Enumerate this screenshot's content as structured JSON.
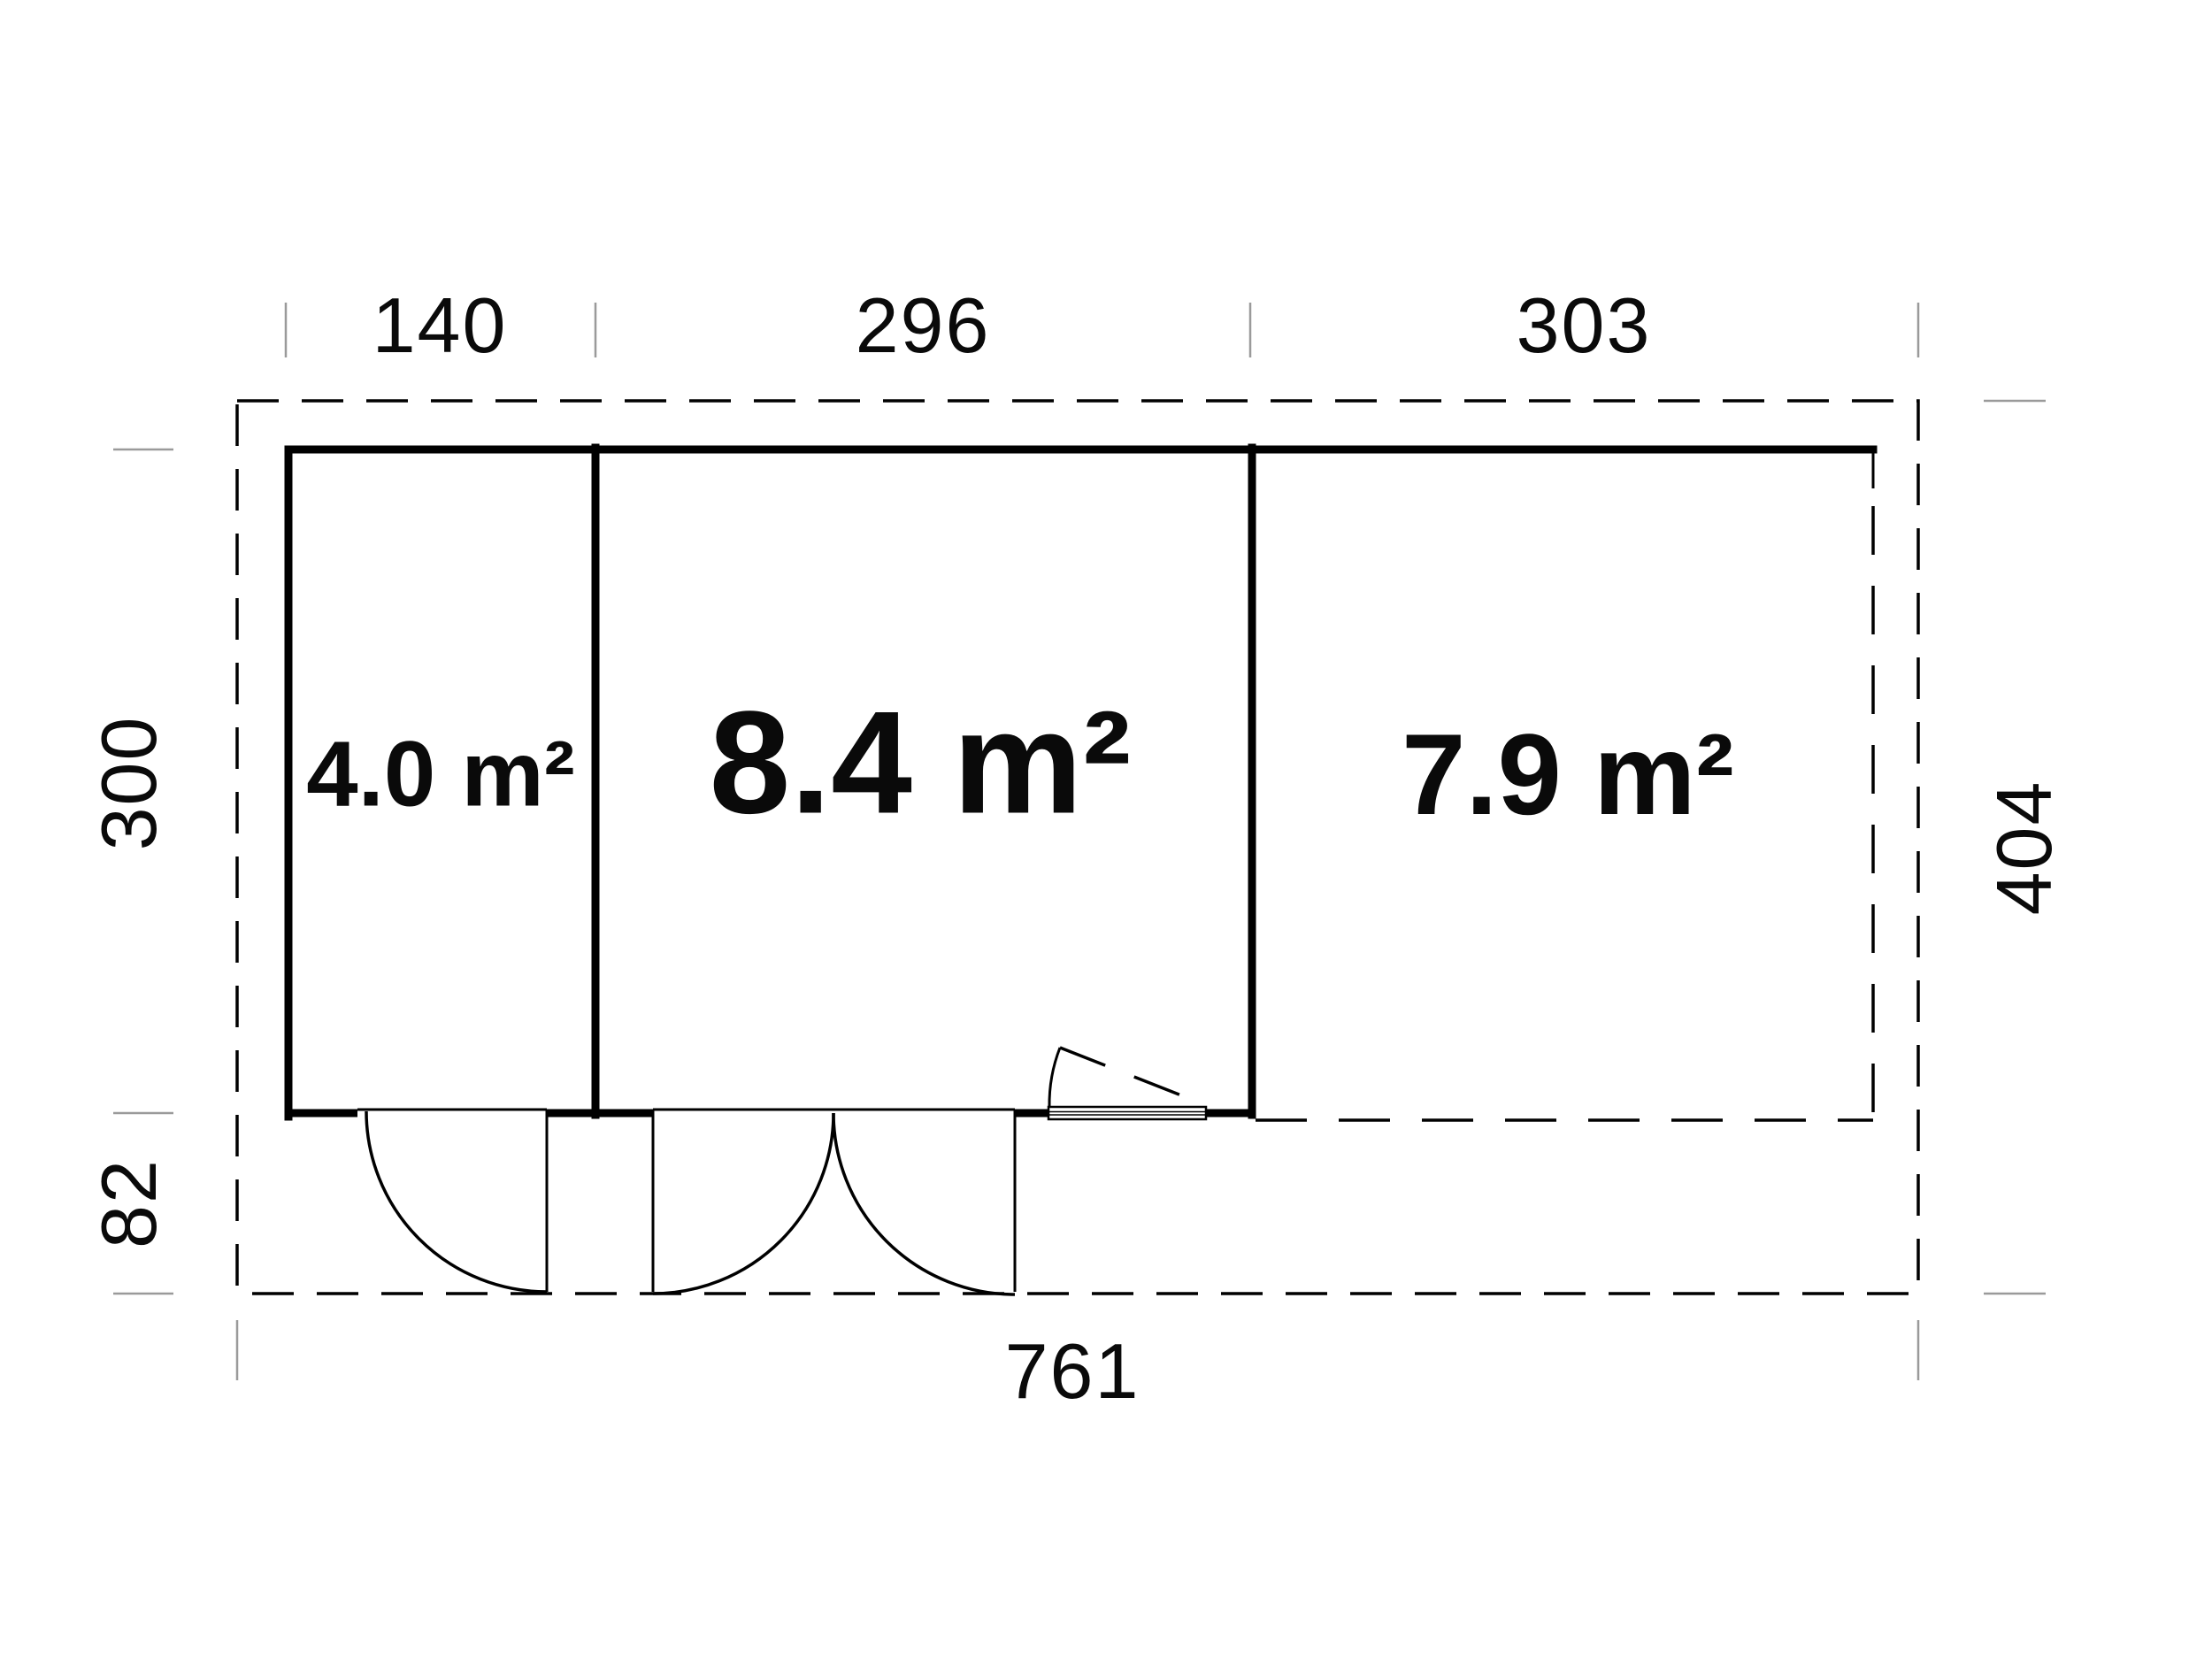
{
  "plan": {
    "title": "garden-house floor plan",
    "rooms": [
      {
        "id": "room-1",
        "area_label": "4.0 m²"
      },
      {
        "id": "room-2",
        "area_label": "8.4 m²"
      },
      {
        "id": "room-3",
        "area_label": "7.9 m²"
      }
    ],
    "dimensions": {
      "top": [
        {
          "label": "140"
        },
        {
          "label": "296"
        },
        {
          "label": "303"
        }
      ],
      "left": [
        {
          "label": "300"
        },
        {
          "label": "82"
        }
      ],
      "right": [
        {
          "label": "404"
        }
      ],
      "bottom": [
        {
          "label": "761"
        }
      ]
    },
    "colors": {
      "line": "#000000",
      "tick": "#9a9a9a",
      "background": "#ffffff",
      "text": "#0a0a0a"
    }
  }
}
